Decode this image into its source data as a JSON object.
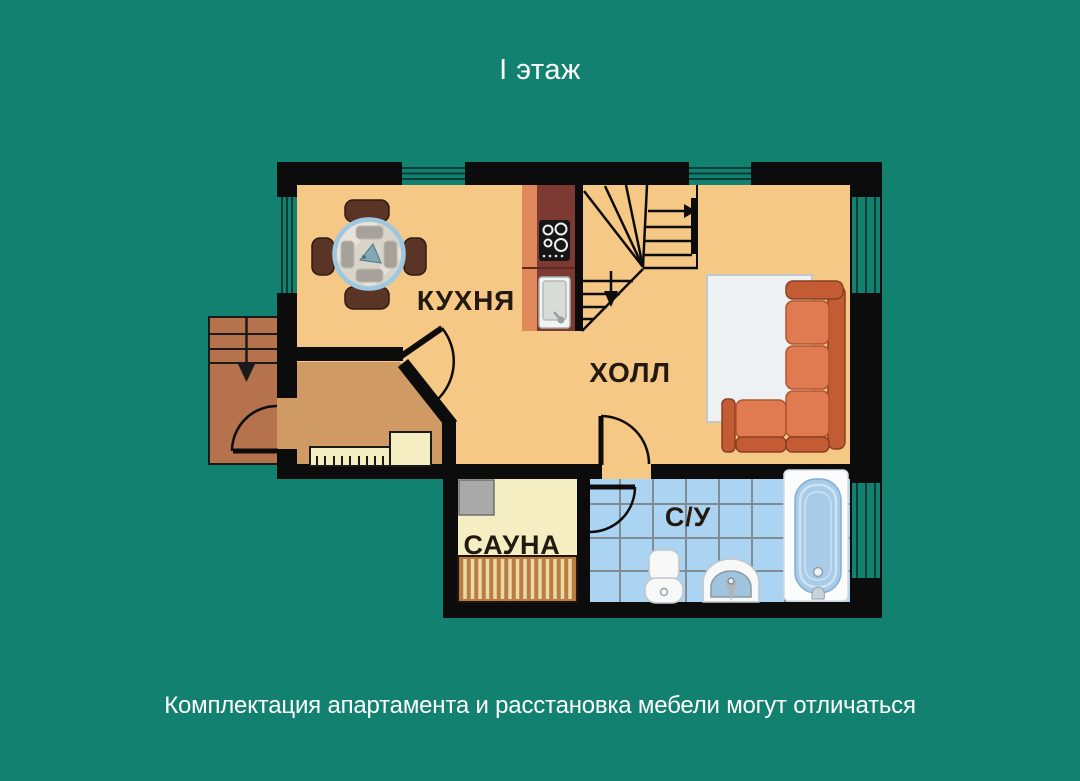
{
  "page": {
    "background_color": "#128170",
    "title": "I этаж",
    "footer_note": "Комплектация апартамента и расстановка мебели могут отличаться"
  },
  "floor_plan": {
    "rooms": {
      "kitchen": {
        "label": "КУХНЯ"
      },
      "hall": {
        "label": "ХОЛЛ"
      },
      "sauna": {
        "label": "САУНА"
      },
      "bathroom": {
        "label": "С/У"
      }
    },
    "features": [
      "entrance-porch-steps",
      "entrance-door",
      "dining-table-with-four-chairs",
      "kitchen-counter",
      "stove",
      "kitchen-sink",
      "winder-staircase",
      "corner-sofa",
      "rug",
      "radiator-bench",
      "sauna-heater",
      "sauna-bench",
      "toilet",
      "washbasin",
      "bathtub",
      "windows"
    ],
    "colors": {
      "wall": "#0c0c0c",
      "floor_main": "#f6c886",
      "floor_entry": "#cf9a63",
      "porch": "#b5724d",
      "sauna_floor": "#f5eec3",
      "bath_tile": "#abd3f2",
      "tile_grout": "#808b94",
      "sofa": "#e07a50",
      "sofa_dark": "#c35c34",
      "counter": "#7c3a33",
      "counter_face": "#e08a5c",
      "table_rim": "#9ec7e0",
      "bench_wood": "#b97c41",
      "window": "#128170"
    }
  }
}
